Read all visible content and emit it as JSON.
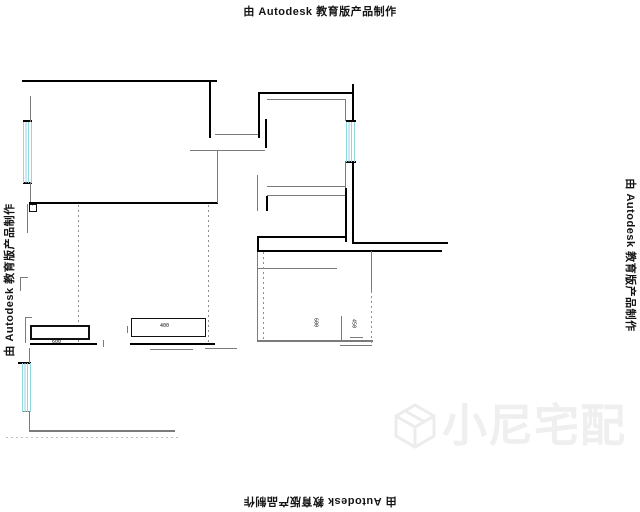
{
  "watermarks": {
    "text": "由 Autodesk 教育版产品制作"
  },
  "brand": {
    "name": "小尼宅配",
    "color": "#efefef"
  },
  "colors": {
    "wall": "#000000",
    "thin_line": "#7b7b7b",
    "window_stripe": "#8fd8e0",
    "background": "#ffffff",
    "watermark_text": "#141414"
  },
  "plan": {
    "segments": [
      [
        22,
        80,
        195,
        2,
        "b"
      ],
      [
        209,
        80,
        2,
        58,
        "b"
      ],
      [
        23,
        120,
        9,
        2,
        "b"
      ],
      [
        23,
        182,
        9,
        2,
        "b"
      ],
      [
        259,
        92,
        95,
        2,
        "b"
      ],
      [
        258,
        92,
        2,
        46,
        "b"
      ],
      [
        265,
        119,
        2,
        29,
        "b"
      ],
      [
        352,
        84,
        2,
        38,
        "b"
      ],
      [
        346,
        120,
        10,
        2,
        "b"
      ],
      [
        346,
        161,
        10,
        2,
        "b"
      ],
      [
        352,
        163,
        2,
        81,
        "b"
      ],
      [
        345,
        188,
        2,
        54,
        "b"
      ],
      [
        266,
        196,
        2,
        15,
        "b"
      ],
      [
        257,
        236,
        90,
        2,
        "b"
      ],
      [
        257,
        236,
        2,
        16,
        "b"
      ],
      [
        353,
        242,
        95,
        2,
        "b"
      ],
      [
        257,
        250,
        185,
        2,
        "b"
      ],
      [
        29,
        202,
        189,
        2,
        "b"
      ],
      [
        30,
        343,
        67,
        2,
        "b"
      ],
      [
        130,
        343,
        85,
        2,
        "b"
      ],
      [
        18,
        362,
        13,
        2,
        "b"
      ],
      [
        30,
        96,
        1,
        26,
        "g"
      ],
      [
        30,
        182,
        1,
        20,
        "g"
      ],
      [
        27,
        204,
        1,
        29,
        "g"
      ],
      [
        20,
        277,
        8,
        1,
        "g"
      ],
      [
        20,
        277,
        1,
        14,
        "g"
      ],
      [
        215,
        134,
        43,
        1,
        "g"
      ],
      [
        190,
        150,
        75,
        1,
        "g"
      ],
      [
        217,
        151,
        1,
        52,
        "g"
      ],
      [
        267,
        99,
        79,
        1,
        "g"
      ],
      [
        345,
        99,
        1,
        22,
        "g"
      ],
      [
        345,
        161,
        1,
        27,
        "g"
      ],
      [
        267,
        186,
        79,
        1,
        "g"
      ],
      [
        267,
        195,
        78,
        1,
        "g"
      ],
      [
        257,
        175,
        1,
        36,
        "g"
      ],
      [
        257,
        252,
        1,
        89,
        "g"
      ],
      [
        257,
        268,
        80,
        1,
        "g"
      ],
      [
        257,
        340,
        116,
        2,
        "g"
      ],
      [
        350,
        337,
        13,
        1,
        "g"
      ],
      [
        340,
        345,
        32,
        1,
        "g"
      ],
      [
        29,
        348,
        1,
        15,
        "g"
      ],
      [
        23,
        411,
        8,
        1,
        "g"
      ],
      [
        29,
        411,
        1,
        21,
        "g"
      ],
      [
        29,
        430,
        146,
        2,
        "g"
      ],
      [
        150,
        349,
        43,
        1,
        "g"
      ],
      [
        205,
        348,
        32,
        1,
        "g"
      ],
      [
        341,
        316,
        1,
        24,
        "g"
      ],
      [
        25,
        317,
        7,
        1,
        "g"
      ],
      [
        25,
        317,
        1,
        26,
        "g"
      ],
      [
        103,
        340,
        1,
        7,
        "g"
      ],
      [
        127,
        326,
        1,
        7,
        "g"
      ],
      [
        371,
        251,
        1,
        40,
        "g"
      ]
    ],
    "dotted": [
      [
        78,
        205,
        1,
        140
      ],
      [
        208,
        205,
        1,
        140
      ],
      [
        263,
        252,
        1,
        88
      ],
      [
        371,
        291,
        1,
        53
      ],
      [
        6,
        437,
        175,
        1
      ]
    ],
    "windows": [
      [
        23,
        122,
        9,
        61
      ],
      [
        346,
        122,
        10,
        40
      ],
      [
        22,
        363,
        9,
        49
      ]
    ],
    "boxes": [
      {
        "x": 30,
        "y": 325,
        "w": 60,
        "h": 15,
        "bw": 2
      },
      {
        "x": 131,
        "y": 318,
        "w": 75,
        "h": 19,
        "bw": 1
      },
      {
        "x": 29,
        "y": 204,
        "w": 8,
        "h": 8,
        "bw": 1
      }
    ],
    "labels": [
      {
        "x": 52,
        "y": 340,
        "text": "600"
      },
      {
        "x": 160,
        "y": 324,
        "text": "400"
      },
      {
        "x": 31,
        "y": 204,
        "text": "·"
      },
      {
        "x": 312,
        "y": 318,
        "text": "600",
        "v": true
      },
      {
        "x": 350,
        "y": 319,
        "text": "450",
        "v": true
      }
    ]
  }
}
